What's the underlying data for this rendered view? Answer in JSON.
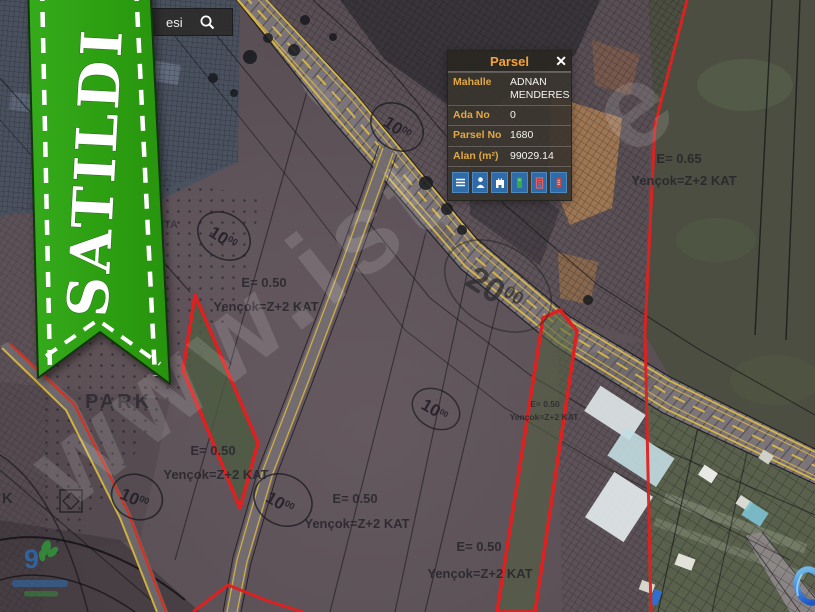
{
  "banner": {
    "label": "SATILDI"
  },
  "search": {
    "value": "esi"
  },
  "popup": {
    "title": "Parsel",
    "close_label": "✕",
    "fields": [
      {
        "label": "Mahalle",
        "value": "ADNAN MENDERES"
      },
      {
        "label": "Ada No",
        "value": "0"
      },
      {
        "label": "Parsel No",
        "value": "1680"
      },
      {
        "label": "Alan (m²)",
        "value": "99029.14"
      }
    ],
    "toolbar_icons": [
      "menu",
      "person",
      "municipality",
      "document",
      "building",
      "archive"
    ]
  },
  "map": {
    "watermark1": "www.ist",
    "watermark2": "e",
    "area_labels": {
      "park": "PARK",
      "orta": "RTA",
      "k": "K"
    },
    "zones": [
      {
        "line1": "E= 0.50",
        "line2": "Yençok=Z+2 KAT"
      },
      {
        "line1": "E= 0.50",
        "line2": "Yençok=Z+2 KAT"
      },
      {
        "line1": "E= 0.50",
        "line2": "Yençok=Z+2 KAT"
      },
      {
        "line1": "E= 0.50",
        "line2": "Yençok=Z+2 KAT"
      },
      {
        "line1": "E= 0.50",
        "line2": "Yençok=Z+2 KAT"
      },
      {
        "line1": "E= 0.65",
        "line2": "Yençok=Z+2 KAT"
      }
    ],
    "callouts": [
      {
        "main": "10",
        "sup": "00"
      },
      {
        "main": "10",
        "sup": "00"
      },
      {
        "main": "10",
        "sup": "00"
      },
      {
        "main": "10",
        "sup": "00"
      },
      {
        "main": "10",
        "sup": "00"
      },
      {
        "main": "20",
        "sup": "00"
      }
    ]
  },
  "logos": {
    "agency_glyph": "9"
  },
  "colors": {
    "banner_green": "#2da012",
    "parcel_red": "#e02020",
    "road_yellow": "#d8b43c",
    "popup_accent": "#f2a43a",
    "button_blue": "#2e6ba8"
  }
}
